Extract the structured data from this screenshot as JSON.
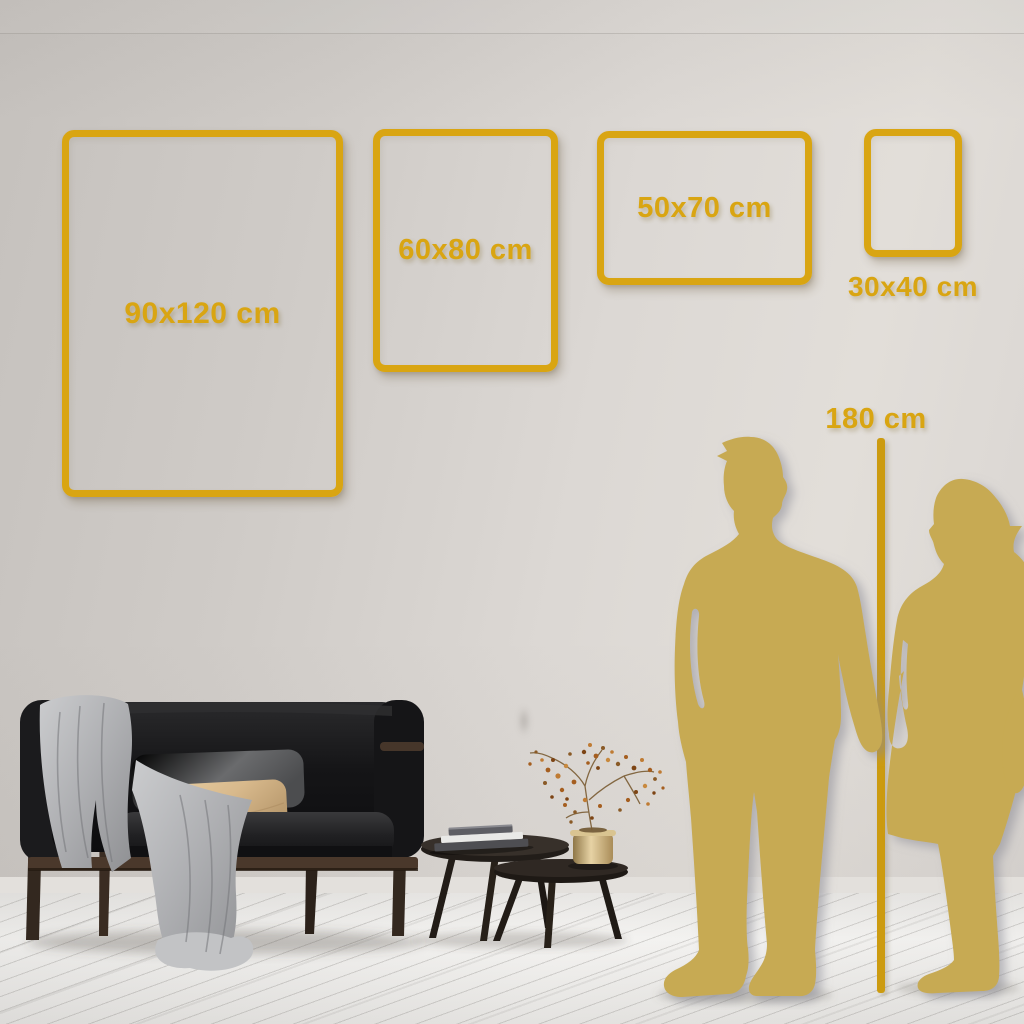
{
  "size_guide": {
    "frames": [
      {
        "id": "90x120",
        "label": "90x120 cm"
      },
      {
        "id": "60x80",
        "label": "60x80 cm"
      },
      {
        "id": "50x70",
        "label": "50x70 cm"
      },
      {
        "id": "30x40",
        "label": "30x40 cm"
      }
    ],
    "height_reference": {
      "label": "180 cm"
    }
  },
  "colors": {
    "accent_gold": "#d9a512",
    "ruler_gold": "#cc9b10",
    "silhouette_gold": "#c7aa52",
    "wall": "#d7d3cf",
    "floor": "#f3f2f0"
  },
  "scene": {
    "illustrations": [
      "couple-silhouette",
      "height-ruler-line",
      "sofa-with-blanket",
      "gray-pillow",
      "tan-pillow",
      "nesting-coffee-tables",
      "books-stack",
      "brass-vase-with-dried-plant",
      "plank-floor"
    ]
  }
}
